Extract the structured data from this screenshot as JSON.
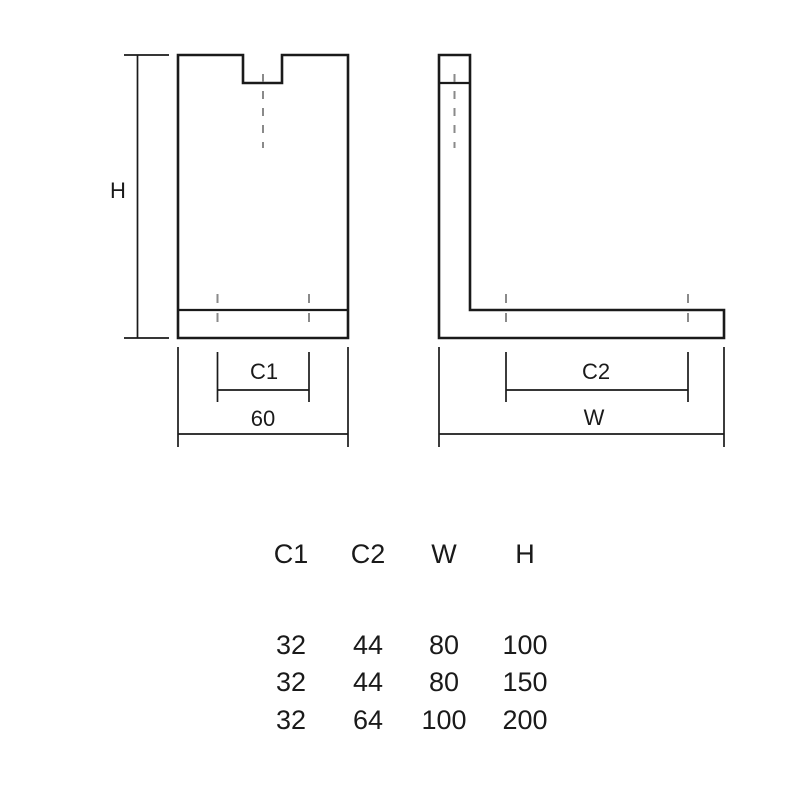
{
  "colors": {
    "line": "#1a1a1a",
    "centerline": "#8a8a8a",
    "background": "#ffffff"
  },
  "drawing": {
    "front_view": {
      "dimensions": {
        "height_label": "H",
        "hole_spacing_label": "C1",
        "base_width_label": "60"
      }
    },
    "side_view": {
      "dimensions": {
        "hole_spacing_label": "C2",
        "base_width_label": "W"
      }
    }
  },
  "spec_table": {
    "headers": [
      "C1",
      "C2",
      "W",
      "H"
    ],
    "rows": [
      [
        "32",
        "44",
        "80",
        "100"
      ],
      [
        "32",
        "44",
        "80",
        "150"
      ],
      [
        "32",
        "64",
        "100",
        "200"
      ]
    ]
  }
}
